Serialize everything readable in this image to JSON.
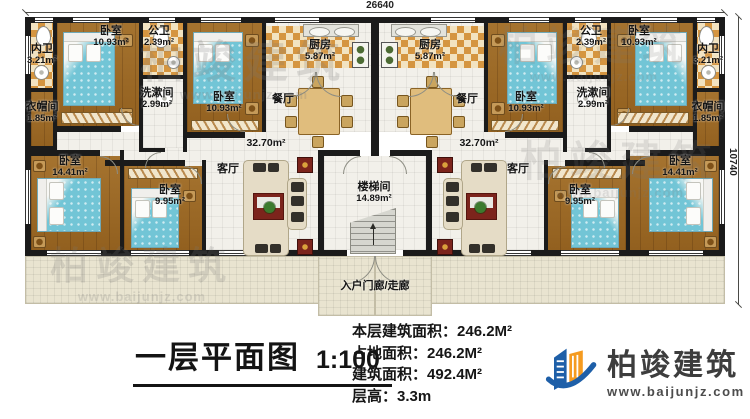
{
  "dimensions": {
    "top": "26640",
    "right": "10740"
  },
  "rooms": [
    {
      "name": "内卫",
      "area": "3.21m²"
    },
    {
      "name": "卧室",
      "area": "10.93m²"
    },
    {
      "name": "公卫",
      "area": "2.39m²"
    },
    {
      "name": "洗漱间",
      "area": "2.99m²"
    },
    {
      "name": "衣帽间",
      "area": "1.85m²"
    },
    {
      "name": "卧室",
      "area": "10.93m²"
    },
    {
      "name": "厨房",
      "area": "5.87m²"
    },
    {
      "name": "餐厅",
      "area": ""
    },
    {
      "name": "",
      "area": "32.70m²"
    },
    {
      "name": "客厅",
      "area": ""
    },
    {
      "name": "卧室",
      "area": "14.41m²"
    },
    {
      "name": "卧室",
      "area": "9.95m²"
    },
    {
      "name": "楼梯间",
      "area": "14.89m²"
    },
    {
      "name": "厨房",
      "area": "5.87m²"
    },
    {
      "name": "公卫",
      "area": "2.39m²"
    },
    {
      "name": "卧室",
      "area": "10.93m²"
    },
    {
      "name": "内卫",
      "area": "3.21m²"
    },
    {
      "name": "洗漱间",
      "area": "2.99m²"
    },
    {
      "name": "卧室",
      "area": "10.93m²"
    },
    {
      "name": "衣帽间",
      "area": "1.85m²"
    },
    {
      "name": "餐厅",
      "area": ""
    },
    {
      "name": "",
      "area": "32.70m²"
    },
    {
      "name": "客厅",
      "area": ""
    },
    {
      "name": "卧室",
      "area": "9.95m²"
    },
    {
      "name": "卧室",
      "area": "14.41m²"
    },
    {
      "name": "入户门廊/走廊",
      "area": ""
    }
  ],
  "title": {
    "text": "一层平面图",
    "scale": "1:100"
  },
  "stats": [
    {
      "label": "本层建筑面积：",
      "value": "246.2M²"
    },
    {
      "label": "占地面积：",
      "value": "246.2M²"
    },
    {
      "label": "建筑面积：",
      "value": "492.4M²"
    },
    {
      "label": "层高：",
      "value": "3.3m"
    }
  ],
  "brand": {
    "name": "柏竣建筑",
    "url": "www.baijunjz.com"
  },
  "watermark": {
    "name": "柏竣建筑",
    "url": "www.baijunjz.com"
  }
}
